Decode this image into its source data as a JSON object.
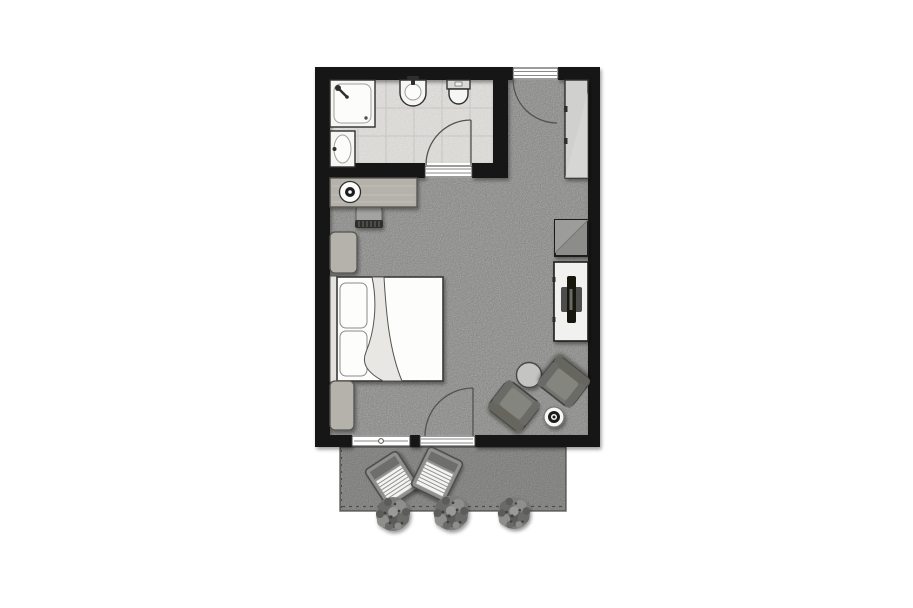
{
  "plan": {
    "kind": "hotel-room-floor-plan",
    "rooms": [
      {
        "name": "bathroom",
        "items": [
          "shower",
          "sink",
          "pedestal-washbasin",
          "toilet",
          "bathroom-door",
          "tiled-floor"
        ]
      },
      {
        "name": "bedroom",
        "items": [
          "entrance-door",
          "wardrobe",
          "desk",
          "desk-lamp",
          "desk-chair",
          "nightstand-top",
          "double-bed",
          "pillows",
          "blanket",
          "nightstand-bottom",
          "minibar-cabinet",
          "tv-sideboard",
          "tv",
          "coffee-table",
          "armchair-left",
          "armchair-right",
          "side-table",
          "terrace-door",
          "window",
          "carpet-floor"
        ]
      },
      {
        "name": "terrace",
        "items": [
          "sun-lounger-left",
          "sun-lounger-right",
          "shrub-1",
          "shrub-2",
          "shrub-3"
        ]
      }
    ]
  },
  "colors": {
    "background": "#ffffff",
    "wall": "#141414",
    "carpet": "#c6c6c4",
    "bathroom_floor": "#f0efec",
    "terrace": "#adadab",
    "terrace_edge": "#6e6e6c",
    "terrace_dash": "#4c4c4a",
    "wood": "#b5b2ac",
    "wood_edge": "#55534f",
    "linen": "#fdfdfb",
    "blanket": "#e9e7e3",
    "headboard": "#e4e2de",
    "wardrobe": "#d0d0ce",
    "minibar": "#8c8c8a",
    "console": "#f1f1ef",
    "tv": "#131311",
    "tv_base": "#4e4e4c",
    "armchair": "#73736f",
    "coffee_table": "#c4c4c2",
    "side_table": "#f8f8f6",
    "bush": "#7c7c7a",
    "threshold": "#ffffff",
    "door_line": "#55534f"
  }
}
